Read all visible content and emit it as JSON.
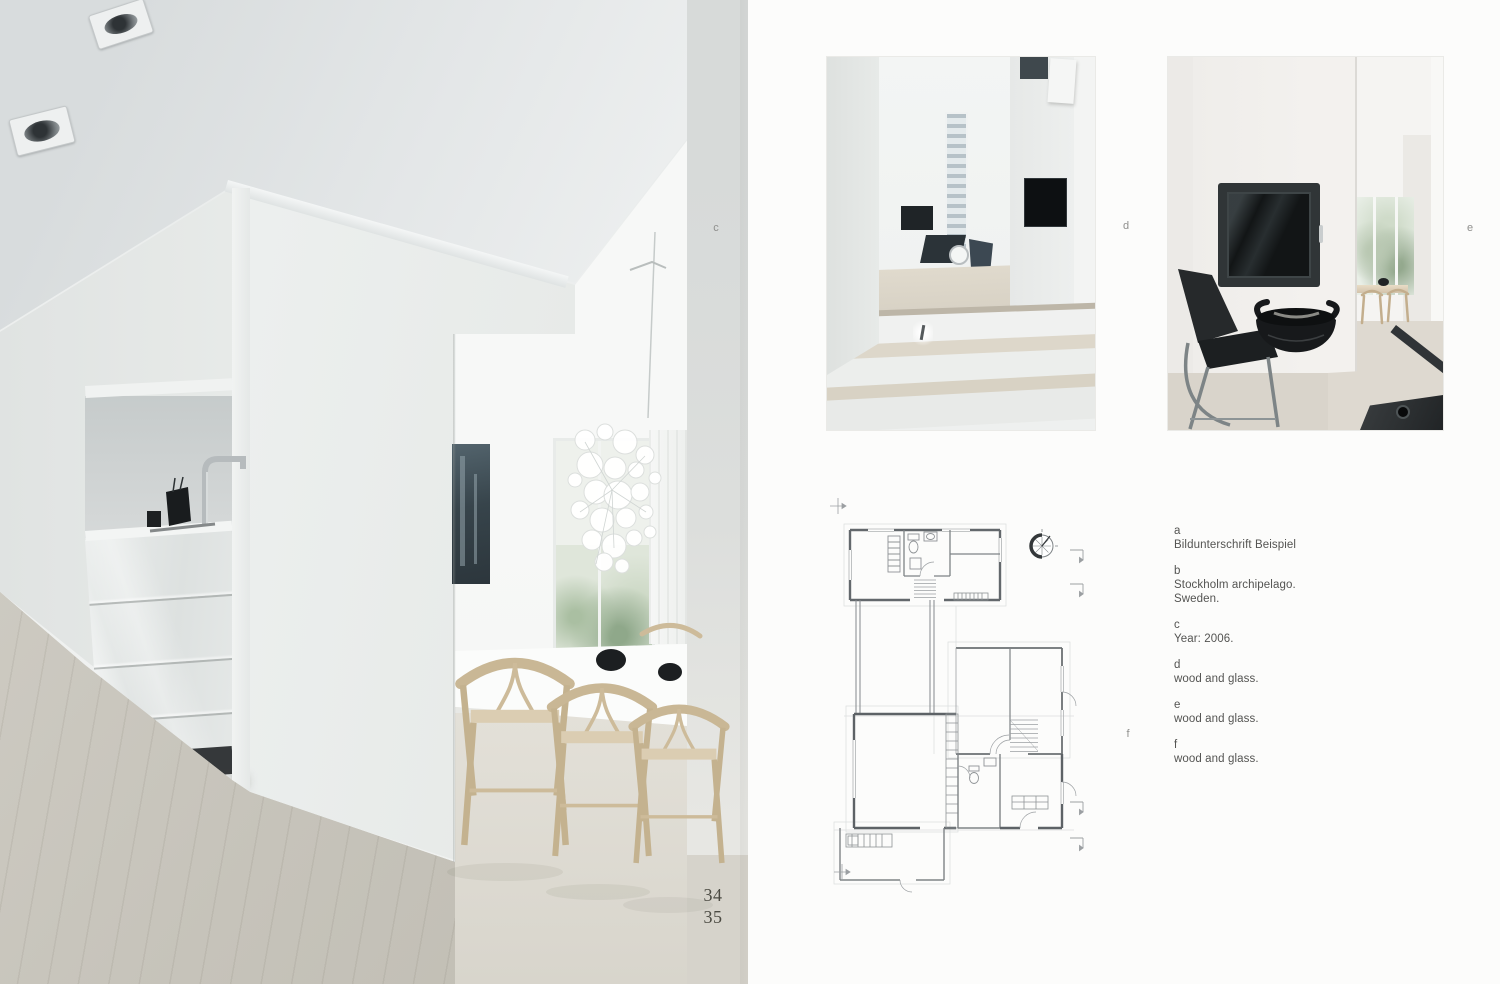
{
  "page": {
    "folio_top": "34",
    "folio_bottom": "35"
  },
  "markers": {
    "c": "c",
    "d": "d",
    "e": "e",
    "f": "f"
  },
  "captions": {
    "a": {
      "letter": "a",
      "line1": "Bildunterschrift Beispiel"
    },
    "b": {
      "letter": "b",
      "line1": "Stockholm archipelago.",
      "line2": "Sweden."
    },
    "c": {
      "letter": "c",
      "line1": "Year: 2006."
    },
    "d": {
      "letter": "d",
      "line1": "wood and glass."
    },
    "e": {
      "letter": "e",
      "line1": "wood and glass."
    },
    "f": {
      "letter": "f",
      "line1": "wood and glass."
    }
  },
  "colors": {
    "paper": "#fcfcfb",
    "caption_text": "#545452",
    "folio_text": "#4b4a42",
    "marker_text": "#8f8f8d",
    "plan_line_light": "#9b9fa2",
    "plan_wall_dark": "#5d6266",
    "wood_chair": "#c9b795",
    "stove_black": "#121516",
    "floor_wood": "#d6d3cb"
  }
}
